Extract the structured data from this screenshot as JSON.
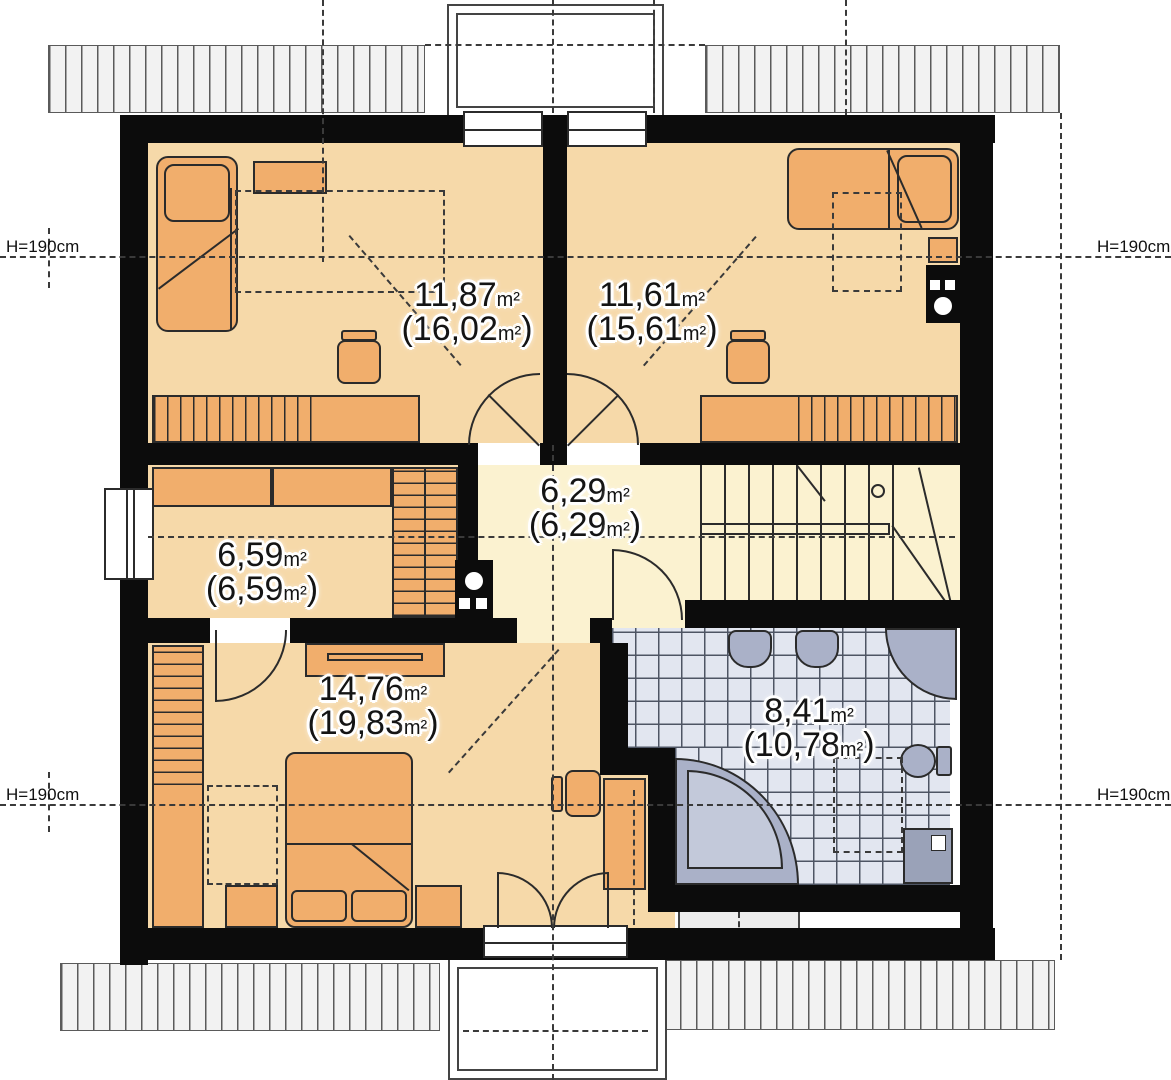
{
  "title": "attic floor plan",
  "colors": {
    "floor_bedroom": "#f6d9a9",
    "floor_hall": "#fbf2d0",
    "furniture": "#f1ae6c",
    "bath_tile": "#e2e6f0",
    "bath_fixture": "#aab1c8",
    "wall": "#0c0c0c",
    "eave": "#f2f2f2"
  },
  "height_markers": [
    {
      "text": "H=190cm"
    },
    {
      "text": "H=190cm"
    },
    {
      "text": "H=190cm"
    },
    {
      "text": "H=190cm"
    }
  ],
  "rooms": [
    {
      "id": "bedroom-top-left",
      "area": "11,87",
      "unit": "m²",
      "open": "(",
      "area_total": "16,02",
      "unit2": "m²",
      "close": ")"
    },
    {
      "id": "bedroom-top-right",
      "area": "11,61",
      "unit": "m²",
      "open": "(",
      "area_total": "15,61",
      "unit2": "m²",
      "close": ")"
    },
    {
      "id": "hall",
      "area": "6,29",
      "unit": "m²",
      "open": "(",
      "area_total": "6,29",
      "unit2": "m²",
      "close": ")"
    },
    {
      "id": "room-left",
      "area": "6,59",
      "unit": "m²",
      "open": "(",
      "area_total": "6,59",
      "unit2": "m²",
      "close": ")"
    },
    {
      "id": "bedroom-bottom",
      "area": "14,76",
      "unit": "m²",
      "open": "(",
      "area_total": "19,83",
      "unit2": "m²",
      "close": ")"
    },
    {
      "id": "bathroom",
      "area": "8,41",
      "unit": "m²",
      "open": "(",
      "area_total": "10,78",
      "unit2": "m²",
      "close": ")"
    }
  ]
}
